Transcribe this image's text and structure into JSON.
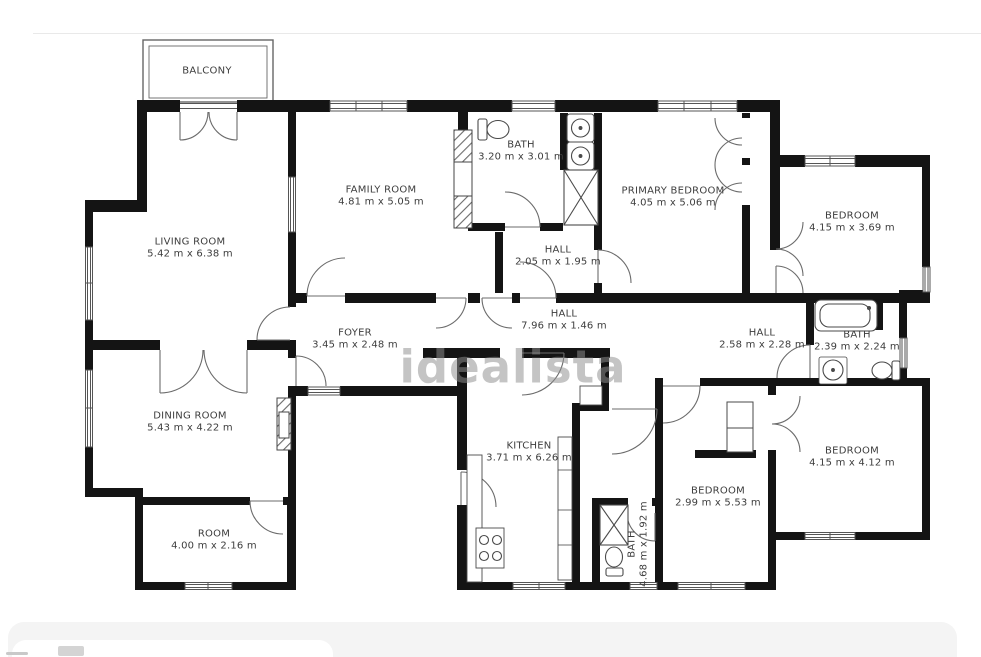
{
  "watermark": "idealista",
  "floorplan": {
    "rooms": [
      {
        "id": "balcony",
        "name": "BALCONY",
        "dims": ""
      },
      {
        "id": "living-room",
        "name": "LIVING ROOM",
        "dims": "5.42 m x 6.38 m"
      },
      {
        "id": "family-room",
        "name": "FAMILY ROOM",
        "dims": "4.81 m x 5.05 m"
      },
      {
        "id": "bath-top",
        "name": "BATH",
        "dims": "3.20 m x 3.01 m"
      },
      {
        "id": "primary-bedroom",
        "name": "PRIMARY BEDROOM",
        "dims": "4.05 m x 5.06 m"
      },
      {
        "id": "bedroom-top-right",
        "name": "BEDROOM",
        "dims": "4.15 m x 3.69 m"
      },
      {
        "id": "hall-small",
        "name": "HALL",
        "dims": "2.05 m x 1.95 m"
      },
      {
        "id": "hall-long",
        "name": "HALL",
        "dims": "7.96 m x 1.46 m"
      },
      {
        "id": "foyer",
        "name": "FOYER",
        "dims": "3.45 m x 2.48 m"
      },
      {
        "id": "hall-right",
        "name": "HALL",
        "dims": "2.58 m x 2.28 m"
      },
      {
        "id": "bath-right",
        "name": "BATH",
        "dims": "2.39 m x 2.24 m"
      },
      {
        "id": "dining-room",
        "name": "DINING ROOM",
        "dims": "5.43 m x 4.22 m"
      },
      {
        "id": "kitchen",
        "name": "KITCHEN",
        "dims": "3.71 m x 6.26 m"
      },
      {
        "id": "bedroom-bottom-mid",
        "name": "BEDROOM",
        "dims": "2.99 m x 5.53 m"
      },
      {
        "id": "bedroom-bottom-right",
        "name": "BEDROOM",
        "dims": "4.15 m x 4.12 m"
      },
      {
        "id": "room",
        "name": "ROOM",
        "dims": "4.00 m x 2.16 m"
      },
      {
        "id": "bath-long",
        "name": "BATH",
        "dims": "4.68 m x 1.92 m"
      }
    ]
  }
}
